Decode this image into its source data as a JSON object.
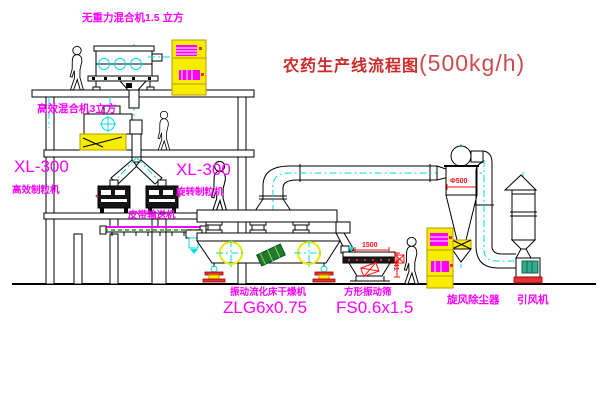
{
  "title": {
    "text": "农药生产线流程图",
    "capacity": "(500kg/h)"
  },
  "labels": {
    "gravity_mixer": "无重力混合机1.5 立方",
    "floor2_mixer": "高效混合机3立方",
    "gran_left_model": "XL-300",
    "gran_left_name": "高效制粒机",
    "gran_mid_model": "XL-300",
    "gran_mid_name": "旋转制粒机",
    "conveyor": "皮带输送机",
    "dryer_name": "振动流化床干燥机",
    "dryer_model": "ZLG6x0.75",
    "screen_name": "方形振动筛",
    "screen_model": "FS0.6x1.5",
    "cyclone": "旋风除尘器",
    "fan": "引风机"
  },
  "dims": {
    "cyclone_dia": "Φ500",
    "screen_len": "1500",
    "screen_h": "341"
  },
  "colors": {
    "label_magenta": "#ff00ff",
    "dimension_red": "#ff1111",
    "title_red": "#cc2b2b",
    "cad_yellow": "#f8ec00",
    "centerline_cyan": "#00dddd",
    "conveyor_green": "#00aa00"
  }
}
